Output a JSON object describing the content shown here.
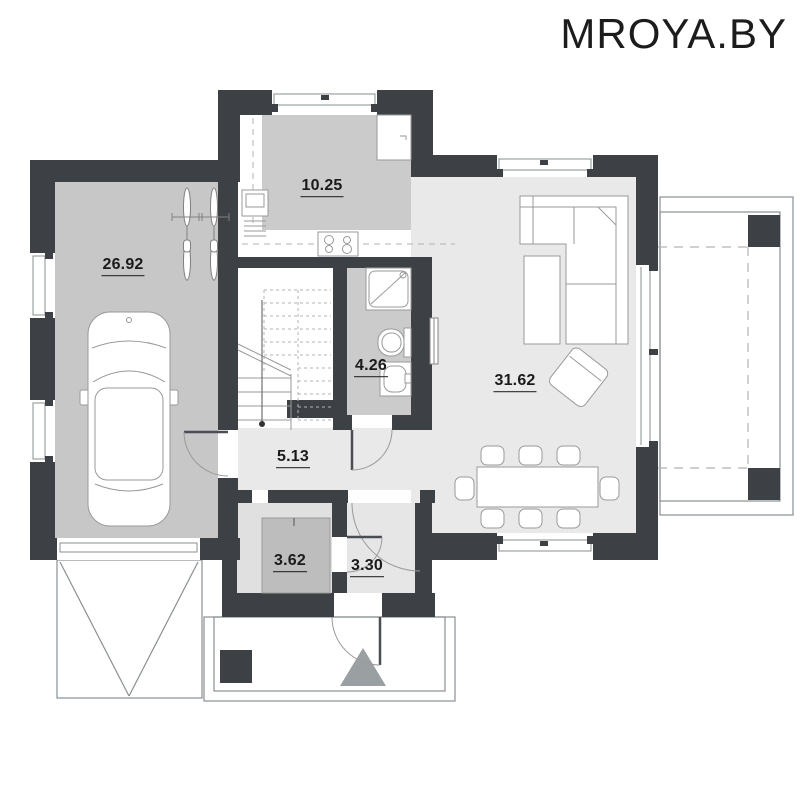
{
  "watermark": {
    "text": "MROYA.BY"
  },
  "floor_plan": {
    "rooms": [
      {
        "id": "garage",
        "area": "26.92"
      },
      {
        "id": "kitchen",
        "area": "10.25"
      },
      {
        "id": "bathroom",
        "area": "4.26"
      },
      {
        "id": "living-room",
        "area": "31.62"
      },
      {
        "id": "hallway",
        "area": "5.13"
      },
      {
        "id": "storage",
        "area": "3.62"
      },
      {
        "id": "entry-hall",
        "area": "3.30"
      }
    ],
    "colors": {
      "wall": "#3d4145",
      "garage_floor": "#c7c7c7",
      "kitchen_floor": "#cbcbcb",
      "bathroom_floor": "#cbcbcb",
      "living_floor": "#e9e9e9",
      "storage_floor": "#e0e0e0",
      "entry_floor": "#e6e6e6",
      "wardrobe_fill": "#bdbdbd",
      "entrance_arrow": "#9aa0a2",
      "line": "#9a9a9a",
      "label_text": "#1a1a1a",
      "background": "#ffffff"
    },
    "fixtures": [
      "car",
      "bicycle",
      "bicycle",
      "staircase",
      "shower",
      "toilet",
      "washbasin",
      "radiator",
      "kitchen-sink",
      "stove",
      "fridge",
      "corner-sofa",
      "coffee-table",
      "armchair",
      "dining-table",
      "dining-chairs",
      "wardrobe",
      "terrace-columns",
      "porch-column",
      "entrance-arrow",
      "garage-door",
      "driveway"
    ]
  }
}
